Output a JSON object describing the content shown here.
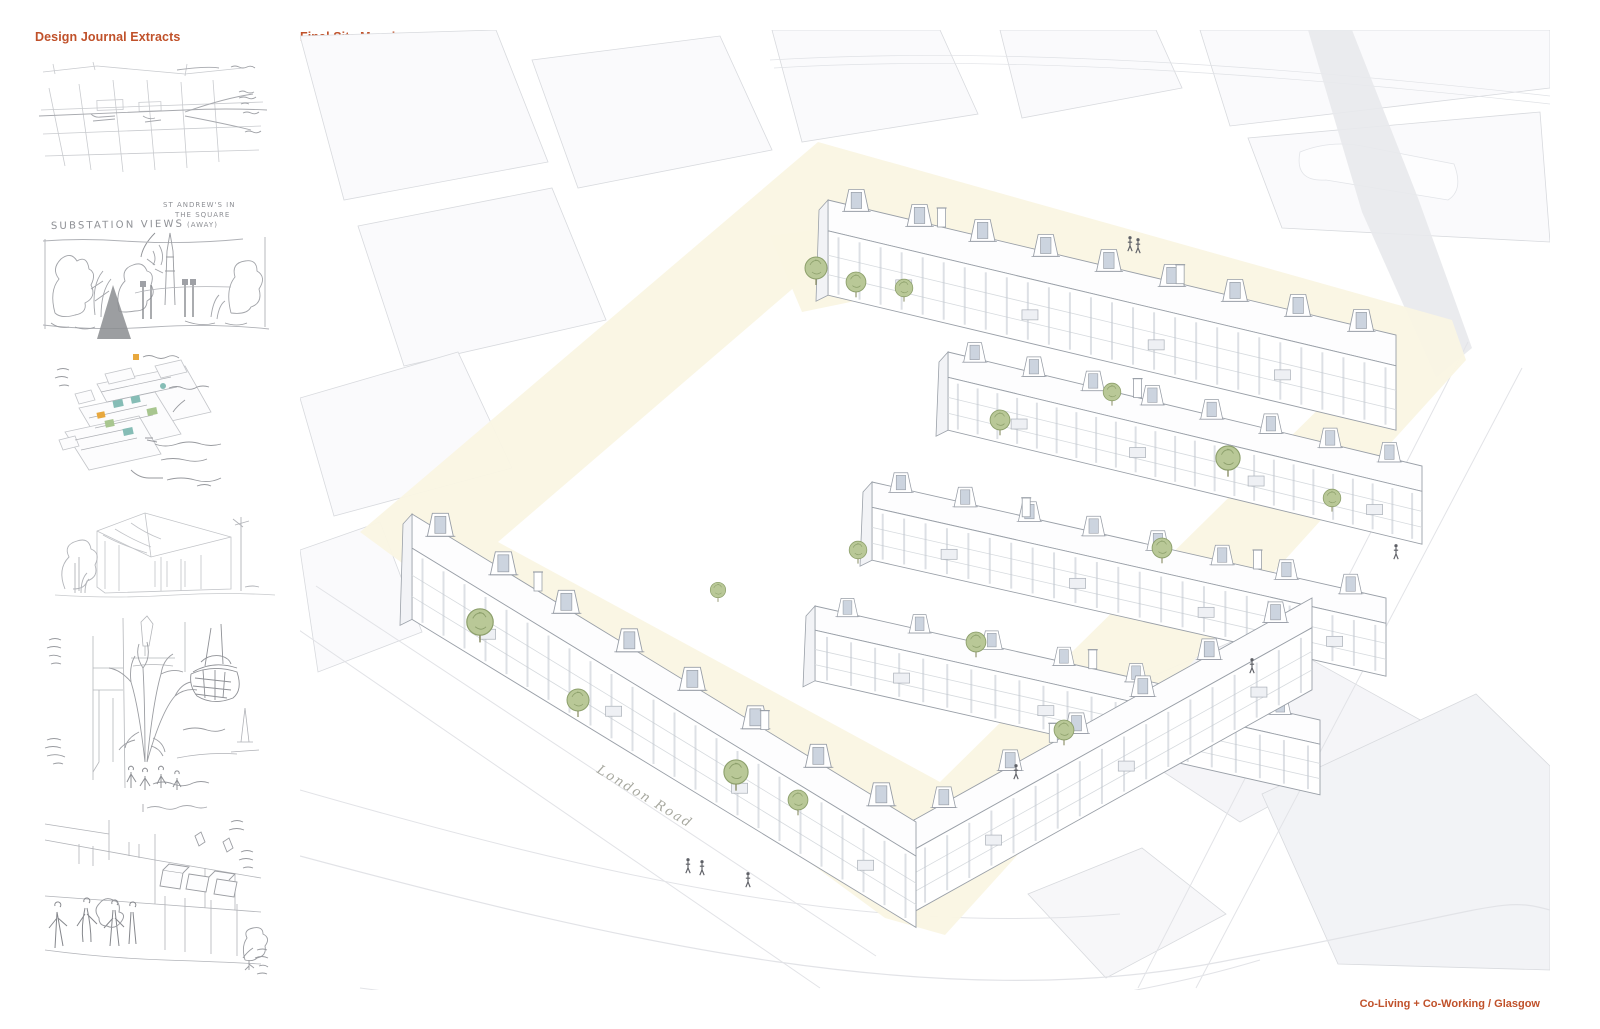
{
  "titles": {
    "left": "Design Journal Extracts",
    "main": "Final Site Massing"
  },
  "footer": {
    "label": "Co-Living + Co-Working / Glasgow"
  },
  "sketches": {
    "substation": {
      "title": "SUBSTATION VIEWS",
      "annotation_line1": "ST ANDREW'S IN",
      "annotation_line2": "THE SQUARE",
      "annotation_line3": "(AWAY)"
    }
  },
  "massing": {
    "road_label": "London Road"
  },
  "palette": {
    "accent": "#c0512a",
    "pencil": "#9b9da2",
    "ink": "#8c9099",
    "ground": "#faf6e3",
    "tree_fill": "#b9c897",
    "tree_stroke": "#8da06c",
    "dormer_glass": "#ccd4df",
    "context_line": "#d8dade"
  }
}
